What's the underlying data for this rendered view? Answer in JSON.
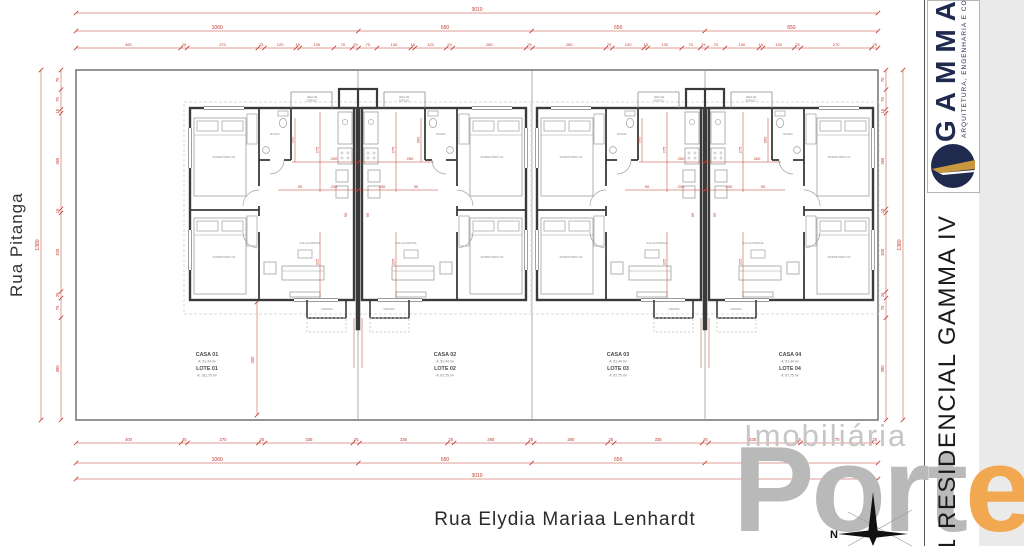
{
  "streets": {
    "left": "Rua Pitanga",
    "bottom": "Rua Elydia Mariaa Lenhardt"
  },
  "watermark": {
    "line1": "Imobiliária",
    "line2_gray": "Port",
    "line2_accent": "e"
  },
  "titleblock": {
    "sheet_title": "1  RESIDENCIAL GAMMA IV"
  },
  "logo": {
    "brand": "GAMMA",
    "tagline": "ARQUITETURA, ENGENHARIA E CONS"
  },
  "compass": {
    "north_label": "N"
  },
  "colors": {
    "dim_red": "#c0392b",
    "navy": "#1f2a4e",
    "gold": "#c9983e",
    "watermark_gray": "#b9b9b9",
    "watermark_accent": "#f2a851"
  },
  "lots": [
    {
      "name": "CASA 01",
      "house_area": "A: 51,44 m²",
      "lote": "LOTE 01",
      "lote_area": "A: 181,75 m²"
    },
    {
      "name": "CASA 02",
      "house_area": "A: 51,44 m²",
      "lote": "LOTE 02",
      "lote_area": "A: 87,75 m²"
    },
    {
      "name": "CASA 03",
      "house_area": "A: 51,44 m²",
      "lote": "LOTE 03",
      "lote_area": "A: 87,75 m²"
    },
    {
      "name": "CASA 04",
      "house_area": "A: 51,44 m²",
      "lote": "LOTE 04",
      "lote_area": "A: 87,75 m²"
    }
  ],
  "rooms": {
    "bedroom1": "DORMITÓRIO 01",
    "bedroom2": "DORMITÓRIO 02",
    "bath": "BANHO",
    "living": "SALA/COZINHA",
    "service_line1": "ÁREA DE",
    "service_line2": "SERVIÇO",
    "porch": "VARANDA"
  },
  "dimensions": {
    "top_overall": "3010",
    "top_row2": [
      "1060",
      "650",
      "650",
      "650"
    ],
    "top_row3": [
      "400",
      "25",
      "270",
      "25",
      "120",
      "15",
      "130",
      "70",
      "25",
      "70",
      "130",
      "15",
      "120",
      "25",
      "280",
      "25",
      "280",
      "25",
      "120",
      "15",
      "130",
      "70",
      "25",
      "70",
      "130",
      "15",
      "120",
      "25",
      "270",
      "25"
    ],
    "bottom_row1": [
      "400",
      "25",
      "270",
      "25",
      "335",
      "25",
      "335",
      "25",
      "280",
      "25",
      "280",
      "25",
      "335",
      "25",
      "335",
      "15",
      "270",
      "25"
    ],
    "bottom_row2": [
      "1060",
      "650",
      "650",
      "650"
    ],
    "bottom_overall": "3010",
    "left_overall": "1380",
    "left_segments": [
      "75",
      "75",
      "15",
      "365",
      "15",
      "300",
      "25",
      "75",
      "390"
    ],
    "right_segments": [
      "75",
      "75",
      "15",
      "365",
      "15",
      "300",
      "25",
      "75",
      "390"
    ],
    "right_overall": "1380",
    "interior": {
      "kitchen_height": "275",
      "bath_width": "360",
      "counter_left": "200",
      "counter_right": "260",
      "hall": "230",
      "door": "90",
      "living_width": "325",
      "center": "95",
      "backyard": "400"
    }
  }
}
